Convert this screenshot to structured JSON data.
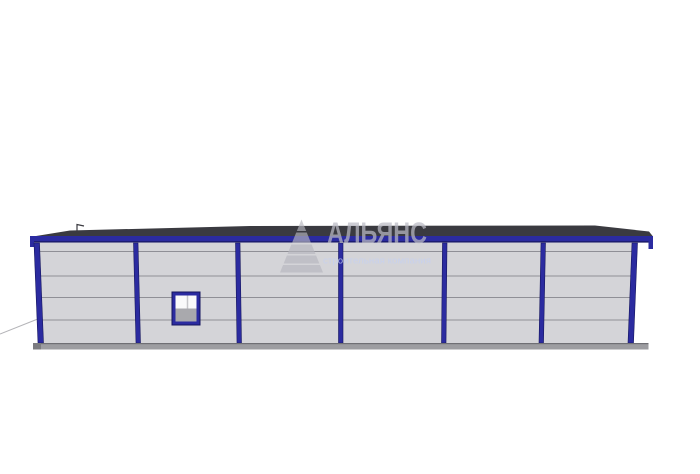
{
  "watermark": {
    "title": "АЛЬЯНС",
    "subtitle": "строительная компания",
    "logo": "striped-pyramid"
  },
  "building": {
    "view": "front-elevation",
    "facade_bays": 6,
    "columns": 7,
    "panel_rows": 5,
    "windows": 1
  },
  "colors": {
    "bg": "#ffffff",
    "blue": "#2b2ba0",
    "blue-dark": "#16165e",
    "roof": "#3a3a40",
    "wall": "#d4d4d8",
    "seam": "#8f8f96",
    "base": "#9d9da1",
    "base-edge": "#6f6f74",
    "base-dark": "#7c7c80",
    "window-white": "#fafafa",
    "window-gray": "#a9a9ad",
    "window-divider": "#c7c7ca",
    "ground-line": "#b4b4b8",
    "wm-gray": "rgba(182,182,190,0.66)",
    "wm-title": "rgba(186,186,196,0.72)",
    "wm-sub": "rgba(198,208,240,0.85)"
  }
}
